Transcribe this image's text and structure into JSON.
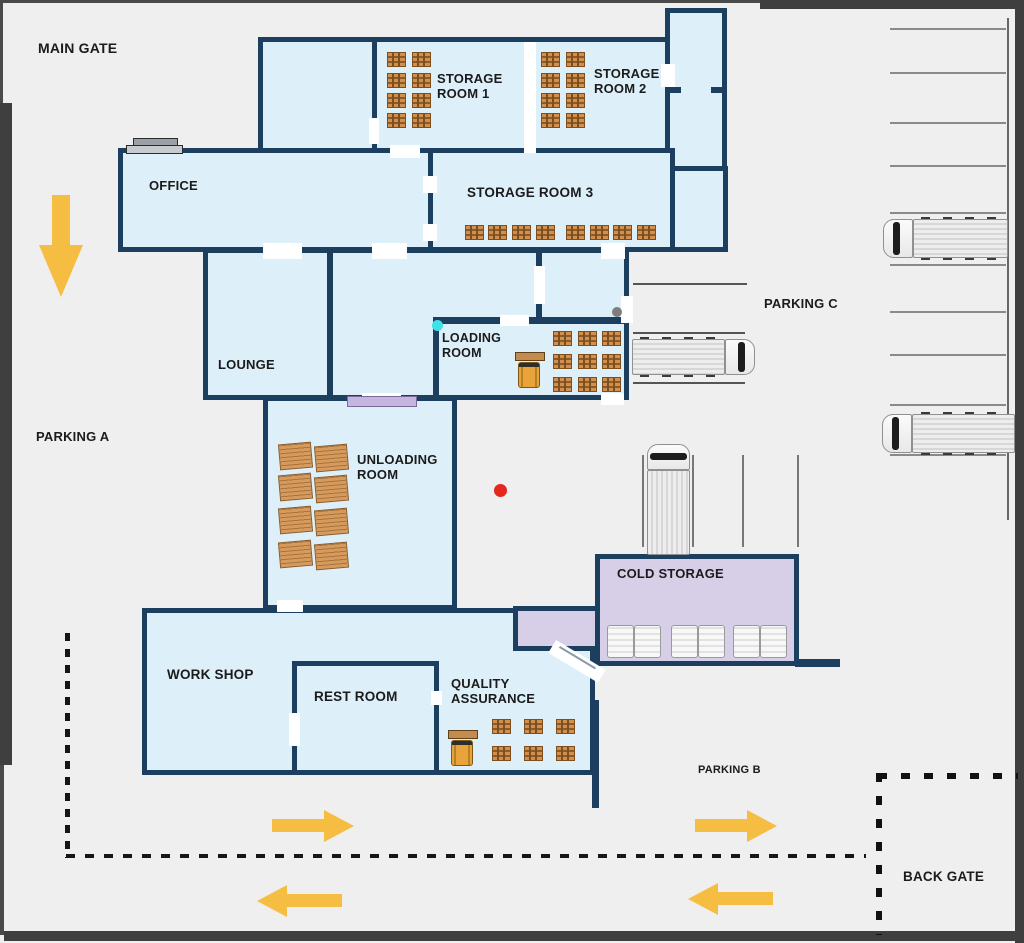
{
  "floor_plan": {
    "gates": {
      "main_gate": "MAIN GATE",
      "back_gate": "BACK GATE"
    },
    "parking_zones": {
      "parking_a": "PARKING A",
      "parking_b": "PARKING B",
      "parking_c": "PARKING C"
    },
    "rooms": {
      "storage_room_1": "STORAGE ROOM 1",
      "storage_room_2": "STORAGE ROOM 2",
      "storage_room_3": "STORAGE ROOM 3",
      "office": "OFFICE",
      "lounge": "LOUNGE",
      "loading_room": "LOADING ROOM",
      "unloading_room": "UNLOADING ROOM",
      "work_shop": "WORK SHOP",
      "rest_room": "REST ROOM",
      "quality_assurance": "QUALITY ASSURANCE",
      "cold_storage": "COLD STORAGE"
    },
    "icons": {
      "pallet_crate": "pallet-crate-icon",
      "pallet_planks": "pallet-planks-icon",
      "forklift": "forklift-icon",
      "truck": "truck-icon",
      "freezer_unit": "freezer-unit-icon",
      "flow_arrow": "flow-arrow-icon",
      "desk": "office-desk-icon"
    },
    "markers": {
      "red_dot": "#e5271d",
      "cyan_dot": "#3ee1e8",
      "gray_dot": "#7d7d7d"
    },
    "inventory_counts": {
      "storage_room_1_pallets": 8,
      "storage_room_2_pallets": 8,
      "storage_room_3_pallets": 8,
      "loading_room_pallets": 9,
      "unloading_room_pallets": 8,
      "quality_assurance_pallets": 6,
      "cold_storage_freezer_units": 6,
      "forklifts": 2,
      "trucks": 4,
      "flow_arrows": 5
    },
    "colors": {
      "pavement": "#efefef",
      "building_fill": "#ddeff8",
      "wall": "#1c3f60",
      "cold_storage_fill": "#d7cfe8",
      "boundary": "#3f3f3f",
      "pallet": "#d28f4e",
      "arrow_yellow": "#f6bd43",
      "dock_mat": "#c6b5de"
    }
  }
}
